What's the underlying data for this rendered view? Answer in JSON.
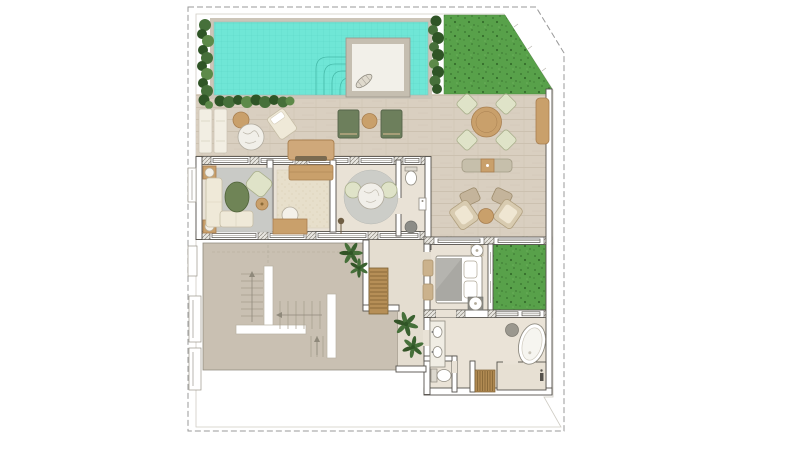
{
  "title": "villa-floor-plan",
  "colors": {
    "page_bg": "#ffffff",
    "boundary_dash": "#9a9a9a",
    "site_line": "#cfccc4",
    "pool_water": "#6fe6d6",
    "pool_grid": "#5cd4c4",
    "pool_steps": "#3fb3a2",
    "lawn": "#58a14a",
    "lawn_speckle": "#3f7d35",
    "hedge_dark": "#2f5526",
    "hedge_mid": "#46703a",
    "hedge_light": "#5d8a49",
    "deck": "#d9cfc0",
    "deck_grain": "#c8bcab",
    "floor": "#e9e2d6",
    "floor_alt": "#e4ddd0",
    "rug_gray": "#c9cac6",
    "rug_round": "#cccdc8",
    "rug_beige": "#e7dfcb",
    "taupe_roof": "#c9c0b2",
    "wall_stroke": "#55524c",
    "wood_tan": "#c9a06b",
    "wood_dark": "#a87f50",
    "wood_stair": "#b68f57",
    "sage": "#dfe3c8",
    "sage_dark": "#a9af8c",
    "green_table": "#6f8456",
    "cream": "#efe9d8",
    "fixture_stroke": "#8f8b80",
    "blanket_gray": "#a9a8a3",
    "stool_gray": "#9b988f",
    "marble": "#f1efe9",
    "plant_green": "#46703a"
  },
  "site": {
    "boundary_style": "dashed",
    "corner_cut": "top-right-diagonal",
    "areas": [
      "pool",
      "upper-lawn",
      "side-lawn",
      "wood-deck-terrace",
      "indoor-rooms",
      "lower-roof-with-stairs"
    ]
  },
  "rooms": [
    {
      "name": "pool-terrace",
      "items": [
        "pool",
        "pool-steps",
        "pool-platform",
        "towel",
        "hedges"
      ]
    },
    {
      "name": "deck",
      "items": [
        "white-loungers",
        "marble-table",
        "round-chair",
        "lounge-chair",
        "green-sun-loungers",
        "side-table",
        "outdoor-sofa"
      ]
    },
    {
      "name": "dining-terrace",
      "items": [
        "dining-table",
        "dining-chairs-4",
        "bench",
        "lounge-set",
        "ottomans",
        "side-bench"
      ]
    },
    {
      "name": "living-room",
      "items": [
        "gray-rug",
        "l-sofa",
        "oval-coffee-table",
        "armchair",
        "side-table",
        "corner-tables"
      ]
    },
    {
      "name": "study",
      "items": [
        "beige-rug",
        "console",
        "desk",
        "desk-chair",
        "floor-lamp"
      ]
    },
    {
      "name": "salon",
      "items": [
        "round-rug",
        "bistro-table",
        "bistro-chairs-2"
      ]
    },
    {
      "name": "wc",
      "items": [
        "toilet",
        "sink",
        "stool"
      ]
    },
    {
      "name": "bedroom",
      "items": [
        "double-bed",
        "pillows",
        "nightstands",
        "foot-ottomans"
      ]
    },
    {
      "name": "hallway",
      "items": [
        "wood-stair-down",
        "palm-plants"
      ]
    },
    {
      "name": "bathroom",
      "items": [
        "vanity-two-sinks",
        "freestanding-bathtub",
        "stool",
        "toilet",
        "teak-mat",
        "shower"
      ]
    },
    {
      "name": "lower-roof",
      "items": [
        "switchback-staircase",
        "direction-arrows",
        "palm-plants"
      ]
    }
  ]
}
